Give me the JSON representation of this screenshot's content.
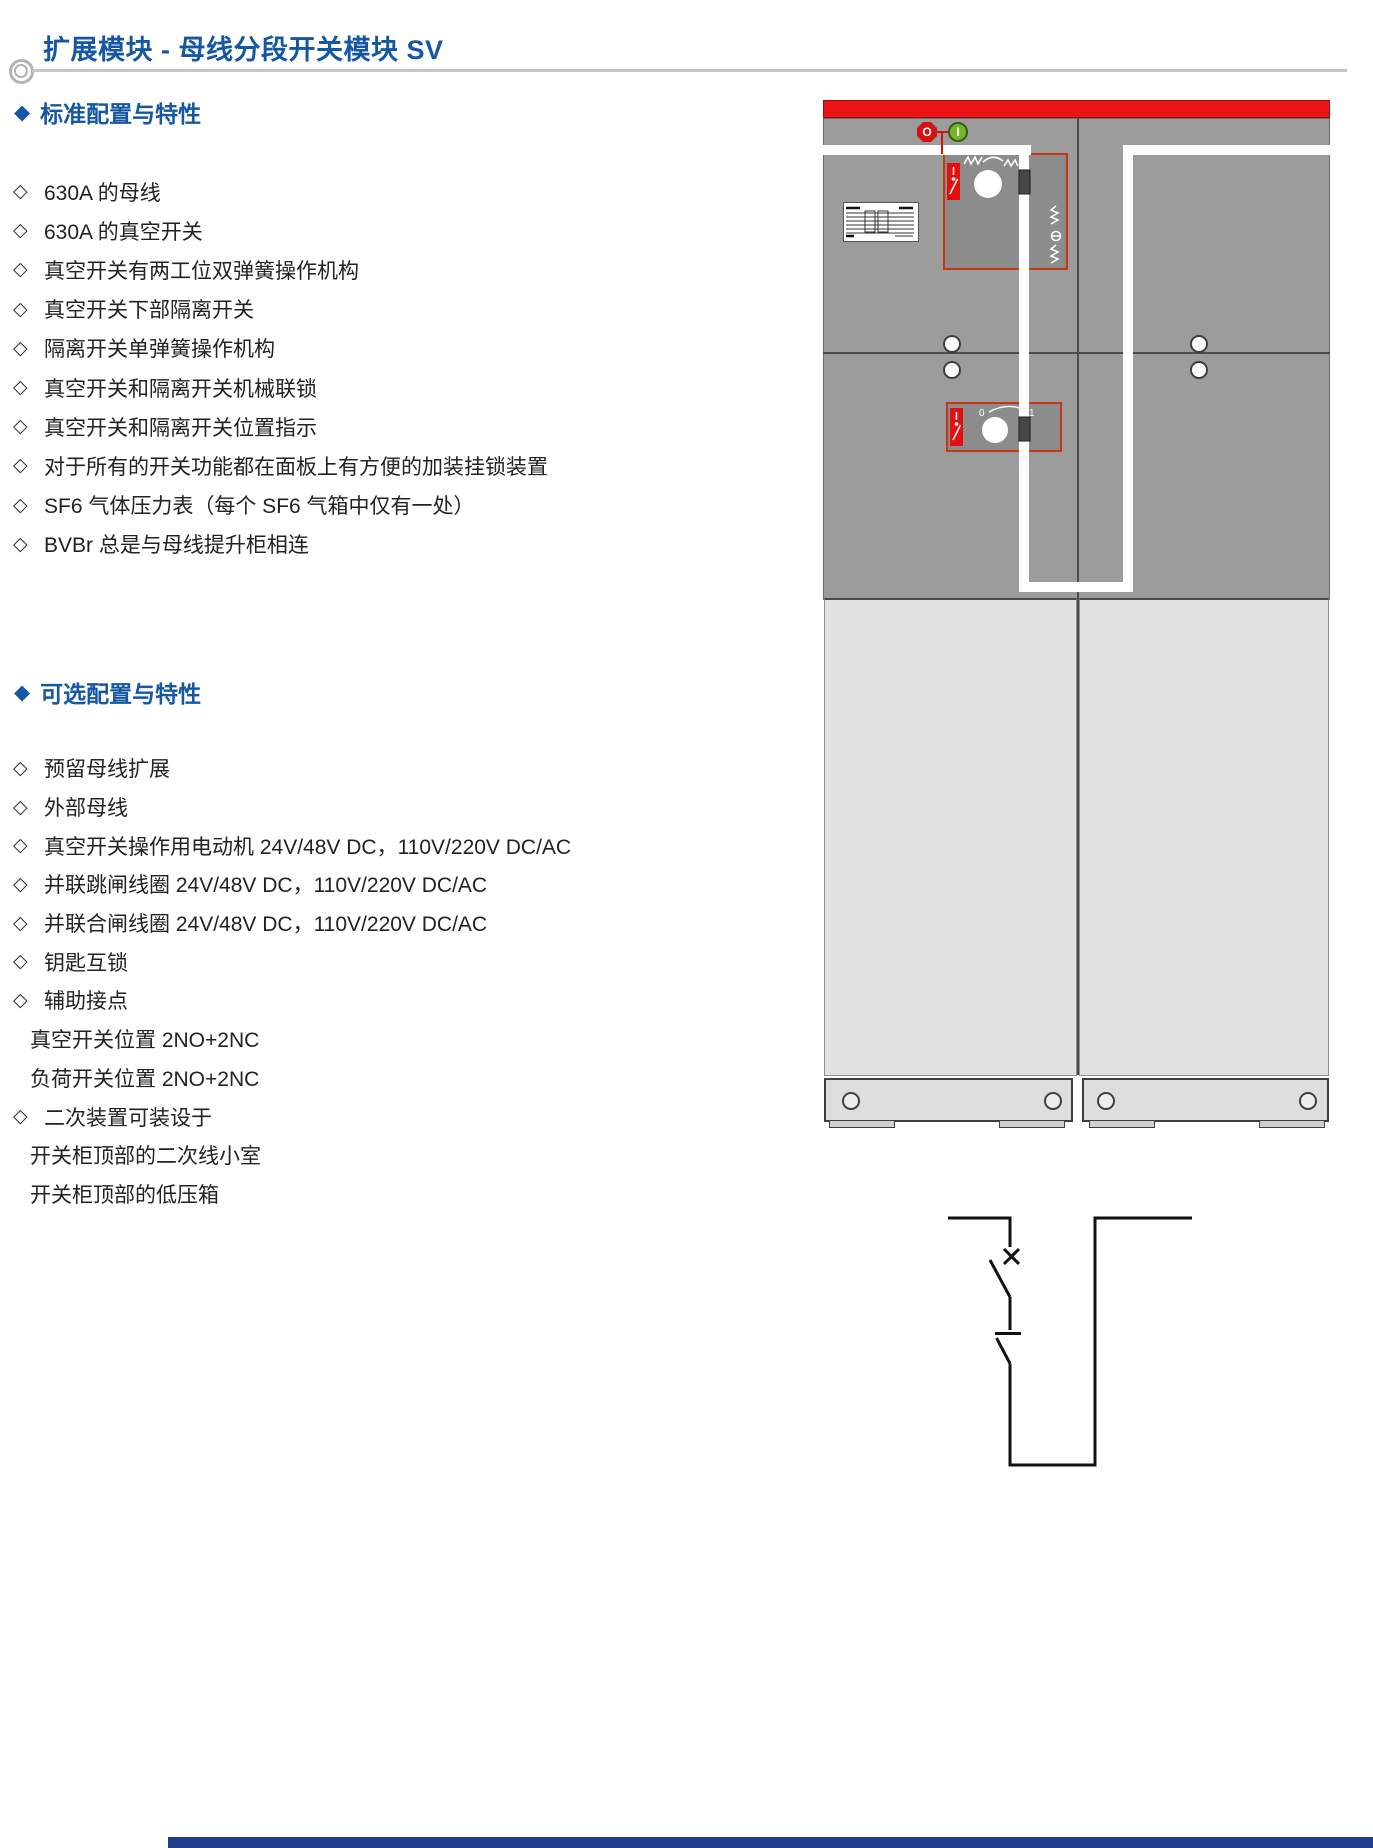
{
  "page": {
    "title": "扩展模块 - 母线分段开关模块 SV",
    "heading_bullet": "◆",
    "item_bullet": "◇"
  },
  "sections": [
    {
      "heading": "标准配置与特性",
      "items": [
        {
          "text": "630A 的母线"
        },
        {
          "text": "630A 的真空开关"
        },
        {
          "text": "真空开关有两工位双弹簧操作机构"
        },
        {
          "text": "真空开关下部隔离开关"
        },
        {
          "text": "隔离开关单弹簧操作机构"
        },
        {
          "text": "真空开关和隔离开关机械联锁"
        },
        {
          "text": "真空开关和隔离开关位置指示"
        },
        {
          "text": "对于所有的开关功能都在面板上有方便的加装挂锁装置"
        },
        {
          "text": "SF6 气体压力表（每个 SF6 气箱中仅有一处）"
        },
        {
          "text": "BVBr 总是与母线提升柜相连"
        }
      ]
    },
    {
      "heading": "可选配置与特性",
      "items": [
        {
          "text": "预留母线扩展"
        },
        {
          "text": "外部母线"
        },
        {
          "text": "真空开关操作用电动机 24V/48V DC，110V/220V DC/AC"
        },
        {
          "text": "并联跳闸线圈 24V/48V DC，110V/220V DC/AC"
        },
        {
          "text": "并联合闸线圈 24V/48V DC，110V/220V DC/AC"
        },
        {
          "text": "钥匙互锁"
        },
        {
          "text": "辅助接点"
        },
        {
          "text": "真空开关位置 2NO+2NC",
          "indent": true
        },
        {
          "text": "负荷开关位置 2NO+2NC",
          "indent": true
        },
        {
          "text": "二次装置可装设于"
        },
        {
          "text": "开关柜顶部的二次线小室",
          "indent": true
        },
        {
          "text": "开关柜顶部的低压箱",
          "indent": true
        }
      ]
    }
  ],
  "cabinet": {
    "off_button_label": "O",
    "on_button_label": "I",
    "rotary_left_label": "0",
    "rotary_right_label": "1"
  },
  "colors": {
    "accent_blue": "#1557a3",
    "cabinet_red": "#ec1414",
    "panel_gray": "#9c9c9c",
    "door_gray": "#e2e2e2",
    "mechanism_red": "#c63612",
    "footer_navy": "#1e3c87"
  }
}
